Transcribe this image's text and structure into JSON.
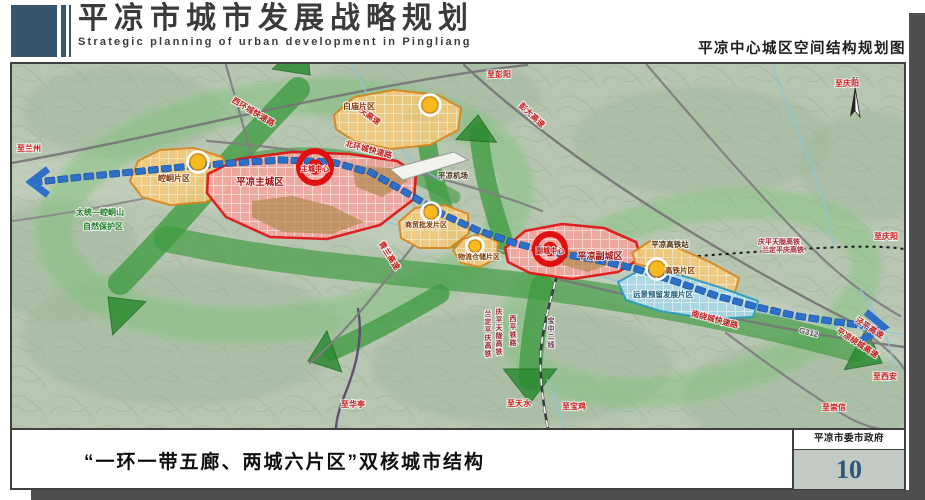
{
  "header": {
    "title": "平凉市城市发展战略规划",
    "title_en": "Strategic planning of urban development in Pingliang",
    "map_caption": "平凉中心城区空间结构规划图"
  },
  "footer": {
    "caption": "“一环一带五廊、两城六片区”双核城市结构",
    "agency": "平凉市委市政府",
    "page_number": "10"
  },
  "map": {
    "north_label": "N",
    "zones": [
      {
        "id": "kongtong",
        "label": "崆峒片区",
        "type": "orange",
        "lx": 172,
        "ly": 180,
        "fs": 8
      },
      {
        "id": "baimiao",
        "label": "白庙片区",
        "type": "orange",
        "lx": 357,
        "ly": 108,
        "fs": 8
      },
      {
        "id": "shangmao",
        "label": "商贸批发片区",
        "type": "orange",
        "lx": 424,
        "ly": 226,
        "fs": 7
      },
      {
        "id": "wuliu",
        "label": "物流仓储片区",
        "type": "orange",
        "lx": 477,
        "ly": 258,
        "fs": 7
      },
      {
        "id": "maincity",
        "label": "平凉主城区",
        "type": "red",
        "lx": 258,
        "ly": 184,
        "fs": 9.5
      },
      {
        "id": "subcity",
        "label": "平凉副城区",
        "type": "red",
        "lx": 598,
        "ly": 258,
        "fs": 9
      },
      {
        "id": "gaotie",
        "label": "高铁片区",
        "type": "orange",
        "lx": 678,
        "ly": 272,
        "fs": 7.5
      },
      {
        "id": "yuanjing",
        "label": "远景预留发展片区",
        "type": "blue",
        "lx": 661,
        "ly": 296,
        "fs": 7.5
      }
    ],
    "centers": [
      {
        "id": "main",
        "label": "主城中心",
        "x": 313,
        "y": 168
      },
      {
        "id": "sub",
        "label": "副城中心",
        "x": 548,
        "y": 250
      }
    ],
    "labels": [
      {
        "t": "至兰州",
        "x": 27,
        "y": 150,
        "c": "dest"
      },
      {
        "t": "至彭阳",
        "x": 497,
        "y": 76,
        "c": "dest"
      },
      {
        "t": "至庆阳",
        "x": 845,
        "y": 85,
        "c": "dest"
      },
      {
        "t": "至庆阳",
        "x": 884,
        "y": 238,
        "c": "dest"
      },
      {
        "t": "至西安",
        "x": 883,
        "y": 378,
        "c": "dest"
      },
      {
        "t": "至崇信",
        "x": 832,
        "y": 409,
        "c": "dest"
      },
      {
        "t": "至华亭",
        "x": 351,
        "y": 406,
        "c": "dest"
      },
      {
        "t": "至天水",
        "x": 517,
        "y": 405,
        "c": "dest"
      },
      {
        "t": "至宝鸡",
        "x": 572,
        "y": 408,
        "c": "dest"
      },
      {
        "t": "平庆高速",
        "x": 363,
        "y": 115,
        "r": 35,
        "c": "road"
      },
      {
        "t": "彭大高速",
        "x": 528,
        "y": 116,
        "r": 43,
        "c": "road"
      },
      {
        "t": "西环城快速路",
        "x": 250,
        "y": 113,
        "r": 31,
        "c": "road"
      },
      {
        "t": "北环城快速路",
        "x": 366,
        "y": 151,
        "r": 15,
        "c": "road"
      },
      {
        "t": "青兰高速",
        "x": 385,
        "y": 256,
        "r": 58,
        "c": "road"
      },
      {
        "t": "南绕城快速路",
        "x": 712,
        "y": 321,
        "r": 15,
        "c": "road"
      },
      {
        "t": "泾平高速",
        "x": 866,
        "y": 329,
        "r": 33,
        "c": "road"
      },
      {
        "t": "平凉绕城高速",
        "x": 854,
        "y": 344,
        "r": 33,
        "c": "road"
      },
      {
        "t": "G312",
        "x": 806,
        "y": 334,
        "r": 14,
        "c": "roadgray"
      },
      {
        "t": "庆平天陇高铁",
        "x": 777,
        "y": 243,
        "c": "rail",
        "fs": 7
      },
      {
        "t": "兰定平庆高铁",
        "x": 781,
        "y": 251,
        "c": "rail",
        "fs": 7
      },
      {
        "t": "兰定平庆高铁",
        "x": 486,
        "y": 315,
        "c": "rail",
        "v": true,
        "fs": 7
      },
      {
        "t": "庆平天陇高铁",
        "x": 497,
        "y": 313,
        "c": "rail",
        "v": true,
        "fs": 7
      },
      {
        "t": "西平铁路",
        "x": 511,
        "y": 320,
        "c": "rail",
        "v": true,
        "fs": 7
      },
      {
        "t": "宝中二线",
        "x": 549,
        "y": 322,
        "c": "raildark",
        "v": true,
        "fs": 7
      },
      {
        "t": "平凉高铁站",
        "x": 668,
        "y": 246,
        "c": "poi",
        "fs": 7.5
      },
      {
        "t": "平凉机场",
        "x": 451,
        "y": 177,
        "c": "poi",
        "fs": 7.5
      },
      {
        "t": "太统—崆峒山",
        "x": 98,
        "y": 214,
        "c": "nature"
      },
      {
        "t": "自然保护区",
        "x": 101,
        "y": 228,
        "c": "nature"
      }
    ],
    "colors": {
      "zone_red_border": "#e01515",
      "zone_orange_border": "#d9861d",
      "zone_blue_border": "#2a9cc4",
      "axis_blue": "#2e6fc8",
      "corridor_green": "#3f9b41",
      "ring_green": "#82c27e",
      "center_red": "#e01010",
      "node_yellow": "#f6b91e"
    }
  }
}
